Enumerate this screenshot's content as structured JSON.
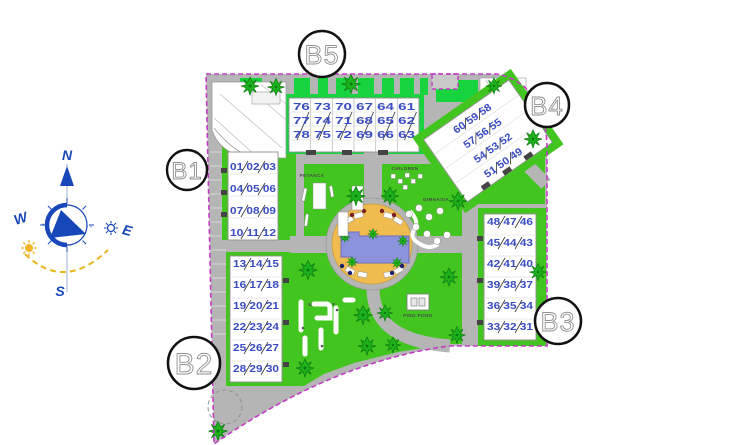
{
  "plan": {
    "compass": {
      "n": "N",
      "s": "S",
      "e": "E",
      "w": "W"
    },
    "labels": {
      "b1": "B1",
      "b2": "B2",
      "b3": "B3",
      "b4": "B4",
      "b5": "B5"
    },
    "amenities": {
      "petanca": "PETANCA",
      "children": "CHILDREN",
      "gym": "GIMNASIA",
      "minigolf": "MINI GOLF",
      "pingpong": "PING PONG"
    },
    "buildings": {
      "b1": {
        "rows": [
          "01 02 03",
          "04 05 06",
          "07 08 09",
          "10 11 12"
        ]
      },
      "b2": {
        "rows": [
          "13 14 15",
          "16 17 18",
          "19 20 21",
          "22 23 24",
          "25 26 27",
          "28 29 30"
        ]
      },
      "b3": {
        "rows": [
          "48 47 46",
          "45 44 43",
          "42 41 40",
          "39 38 37",
          "36 35 34",
          "33 32 31"
        ]
      },
      "b4": {
        "rows": [
          "60 59 58",
          "57 56 55",
          "54 53 52",
          "51 50 49"
        ]
      },
      "b5": {
        "rows": [
          "76 73 70 67 64 61",
          "77 74 71 68 65 62",
          "78 75 72 69 66 63"
        ]
      }
    },
    "colors": {
      "boundary": "#c43bc4",
      "road": "#b5b5b5",
      "grass": "#43c51f",
      "hedge": "#17d33e",
      "pool": "#8d92dc",
      "deck": "#f0bc50",
      "unit_number": "#3a4cc2",
      "compass_blue": "#1747b8",
      "sun_yellow": "#f0b429"
    }
  }
}
